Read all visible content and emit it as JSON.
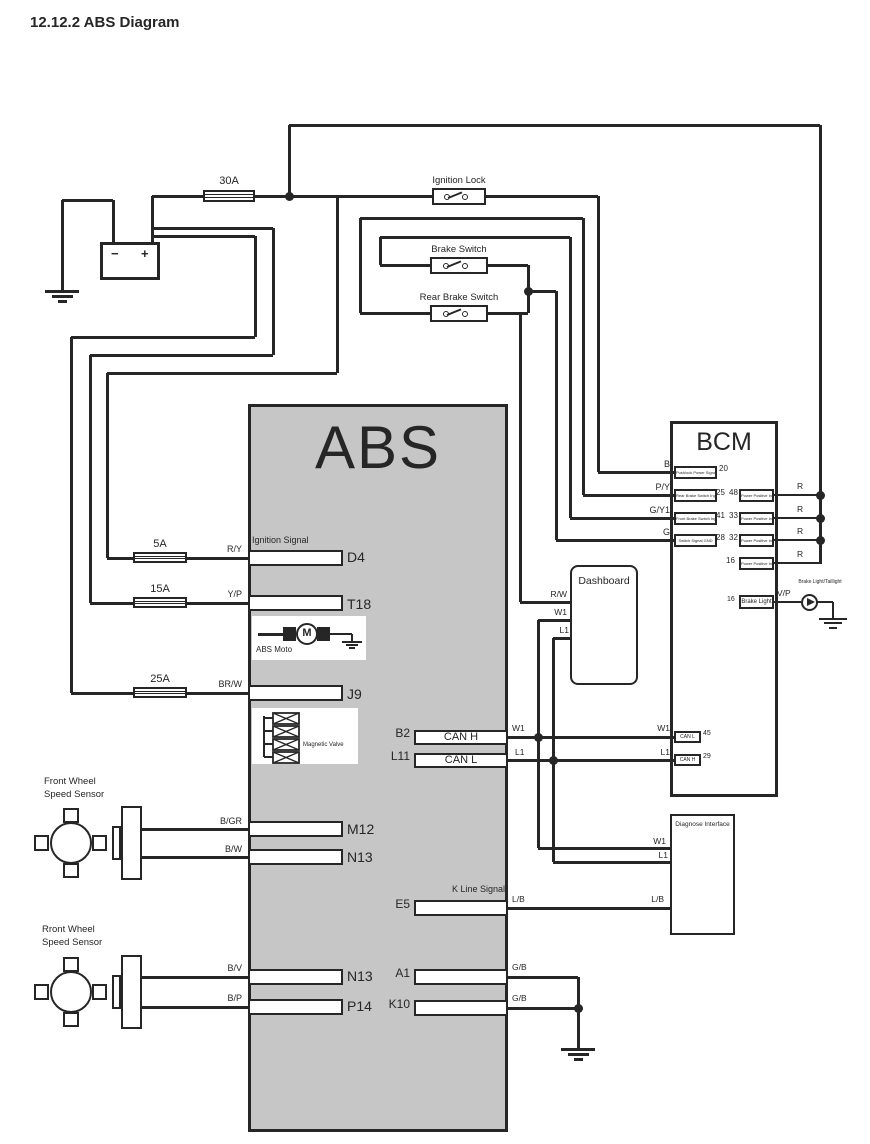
{
  "title": "12.12.2 ABS Diagram",
  "colors": {
    "line": "#262626",
    "abs_fill": "#c6c6c6"
  },
  "battery": {
    "minus": "−",
    "plus": "+"
  },
  "fuses": {
    "f30": "30A",
    "f5": "5A",
    "f15": "15A",
    "f25": "25A"
  },
  "switches": {
    "ignition": "Ignition Lock",
    "brake": "Brake Switch",
    "rear_brake": "Rear Brake Switch"
  },
  "abs": {
    "title": "ABS",
    "motor_label": "ABS Moto",
    "motor_symbol": "M",
    "valve_label": "Magnetic Valve",
    "signals": {
      "ignition": "Ignition Signal",
      "k_line": "K Line Signal"
    },
    "pins": {
      "d4": "D4",
      "t18": "T18",
      "j9": "J9",
      "m12": "M12",
      "n13a": "N13",
      "n13b": "N13",
      "p14": "P14",
      "b2": "B2",
      "l11": "L11",
      "e5": "E5",
      "a1": "A1",
      "k10": "K10"
    },
    "pin_texts": {
      "can_h": "CAN H",
      "can_l": "CAN L"
    }
  },
  "wires": {
    "ry": "R/Y",
    "yp": "Y/P",
    "brw": "BR/W",
    "bgr": "B/GR",
    "bw": "B/W",
    "bv": "B/V",
    "bp": "B/P",
    "b": "B",
    "py": "P/Y",
    "gy1": "G/Y1",
    "g": "G",
    "rw": "R/W",
    "w1": "W1",
    "l1": "L1",
    "lb": "L/B",
    "gb": "G/B",
    "r": "R",
    "vp": "V/P"
  },
  "sensors": {
    "front1": {
      "line1": "Front Wheel",
      "line2": "Speed Sensor"
    },
    "front2": {
      "line1": "Rront Wheel",
      "line2": "Speed Sensor"
    }
  },
  "dashboard": {
    "title": "Dashboard"
  },
  "diagnose": {
    "title": "Diagnose Interface"
  },
  "lamp": {
    "label": "Brake Light/Taillight"
  },
  "bcm": {
    "title": "BCM",
    "pins": {
      "p20": {
        "num": "20",
        "text": "Pushlock Power Signal"
      },
      "p25": {
        "num": "25",
        "text": "Rear Brake Switch Input"
      },
      "p41": {
        "num": "41",
        "text": "Front Brake Switch Input"
      },
      "p28": {
        "num": "28",
        "text": "Switch Signal GND"
      },
      "p48": {
        "num": "48",
        "text": "Power Positive Input"
      },
      "p33": {
        "num": "33",
        "text": "Power Positive Input"
      },
      "p32": {
        "num": "32",
        "text": "Power Positive Input"
      },
      "p16": {
        "num": "16",
        "text": "Power Positive Input"
      },
      "p45": {
        "num": "45",
        "text": "CAN L"
      },
      "p29": {
        "num": "29",
        "text": "CAN H"
      },
      "p16b": {
        "num": "16",
        "text": "Brake Light"
      }
    }
  }
}
